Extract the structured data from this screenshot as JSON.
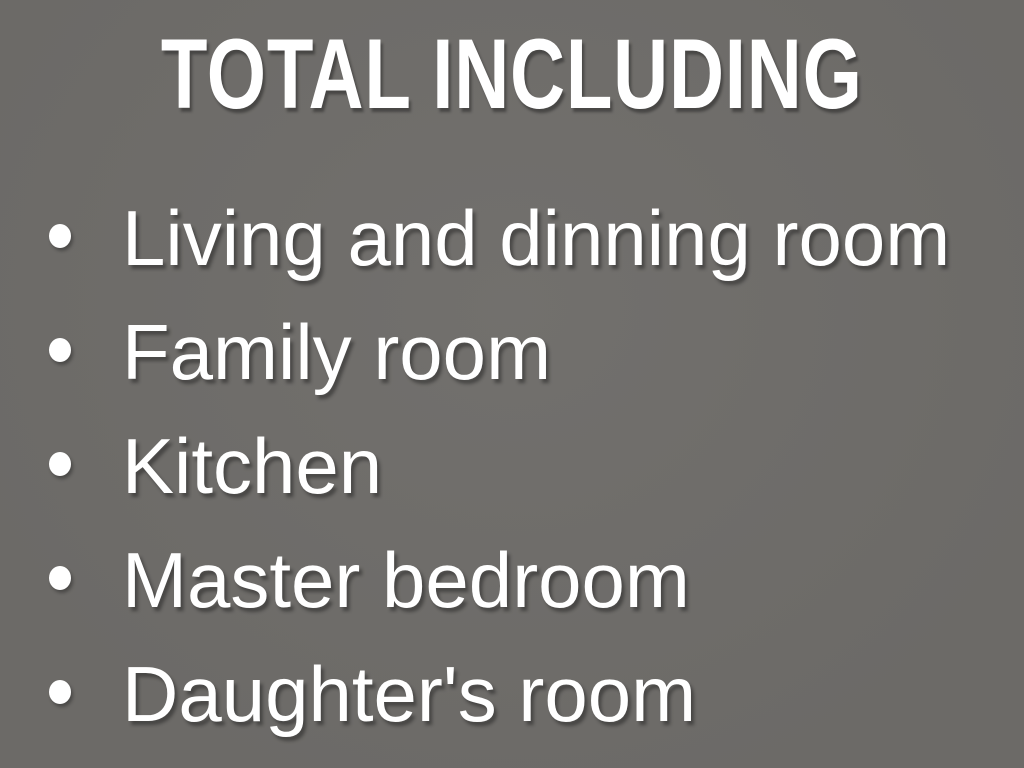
{
  "slide": {
    "title": "TOTAL INCLUDING",
    "bullets": [
      "Living and dinning room",
      "Family room",
      "Kitchen",
      "Master bedroom",
      "Daughter's room"
    ],
    "colors": {
      "background": "#6f6d6a",
      "text": "#ffffff",
      "shadow": "#191919"
    }
  }
}
